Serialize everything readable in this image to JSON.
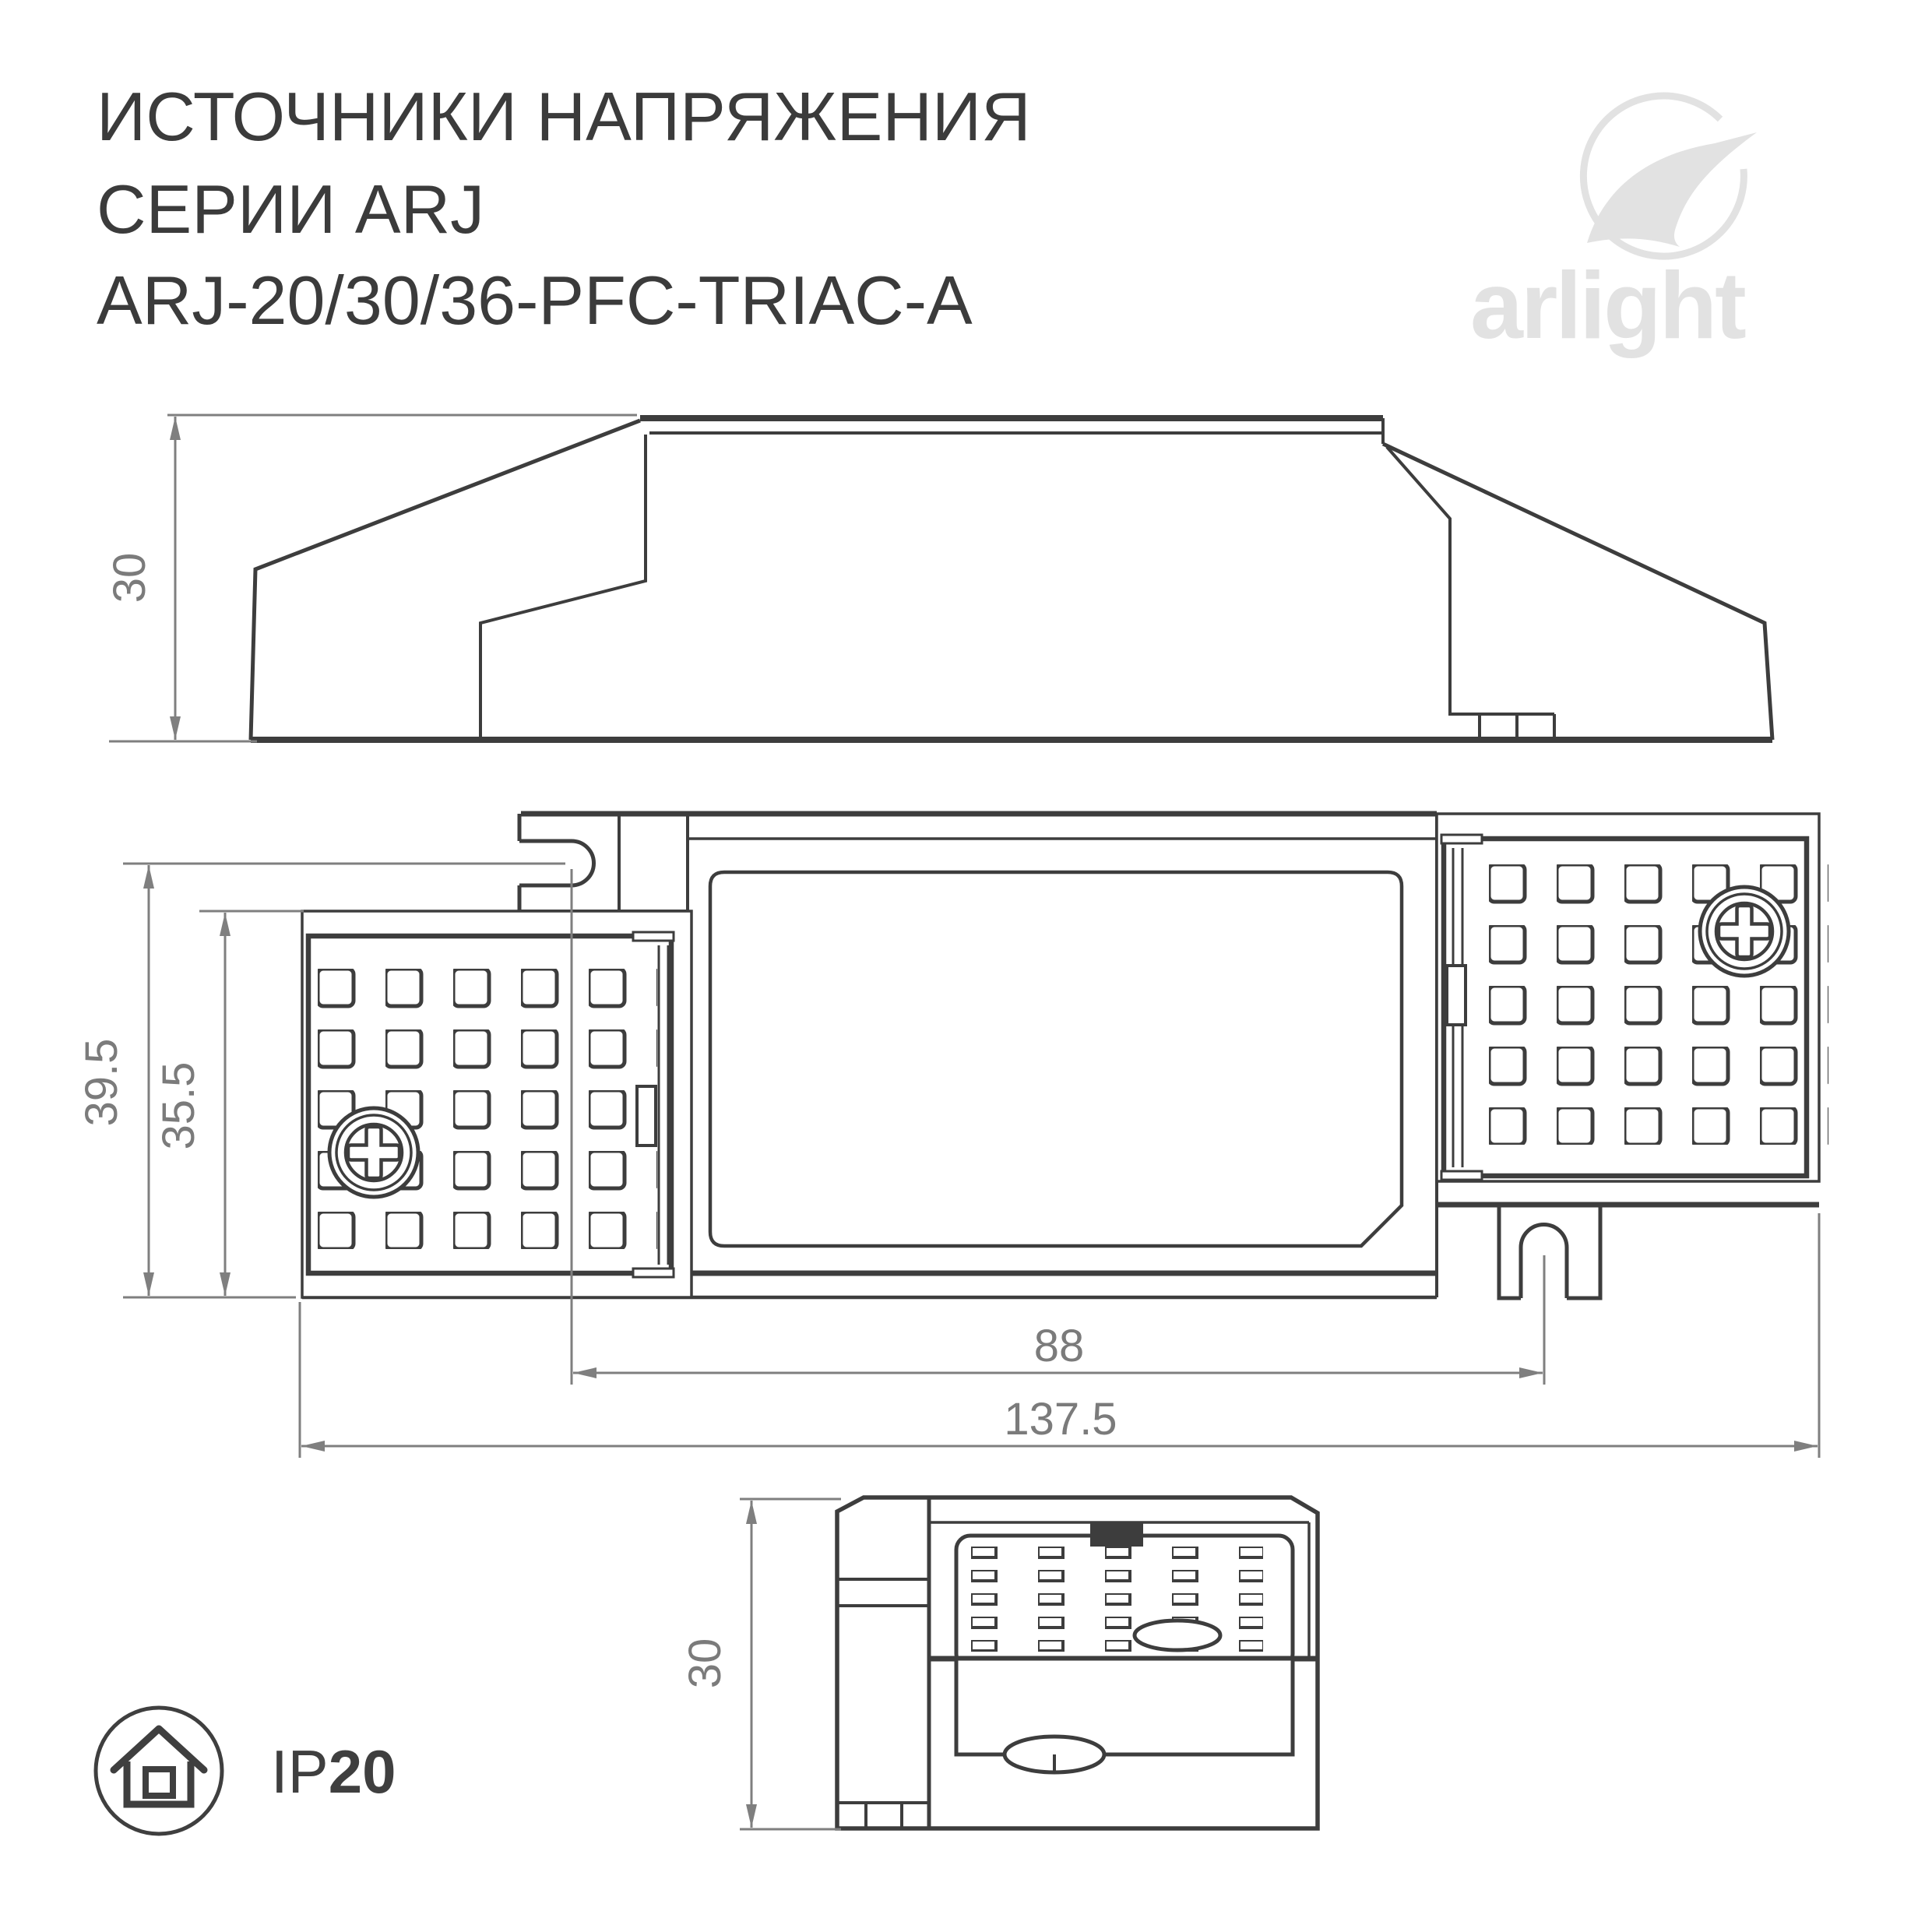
{
  "header": {
    "title_line1": "ИСТОЧНИКИ НАПРЯЖЕНИЯ",
    "title_line2": "СЕРИИ ARJ",
    "title_line3": "ARJ-20/30/36-PFC-TRIAC-A"
  },
  "logo": {
    "text": "arlight"
  },
  "views": {
    "side_view": {
      "height_dim": "30"
    },
    "plan_view": {
      "outer_height_dim": "39.5",
      "plate_height_dim": "35.5",
      "mount_hole_spacing_dim": "88",
      "total_length_dim": "137.5"
    },
    "end_view": {
      "height_dim": "30"
    }
  },
  "badge": {
    "ip_prefix": "IP",
    "ip_value": "20"
  },
  "colors": {
    "drawing_line": "#3d3d3d",
    "dimension_line": "#7f7f7f",
    "logo_gray": "#e2e2e2",
    "background": "#ffffff"
  }
}
